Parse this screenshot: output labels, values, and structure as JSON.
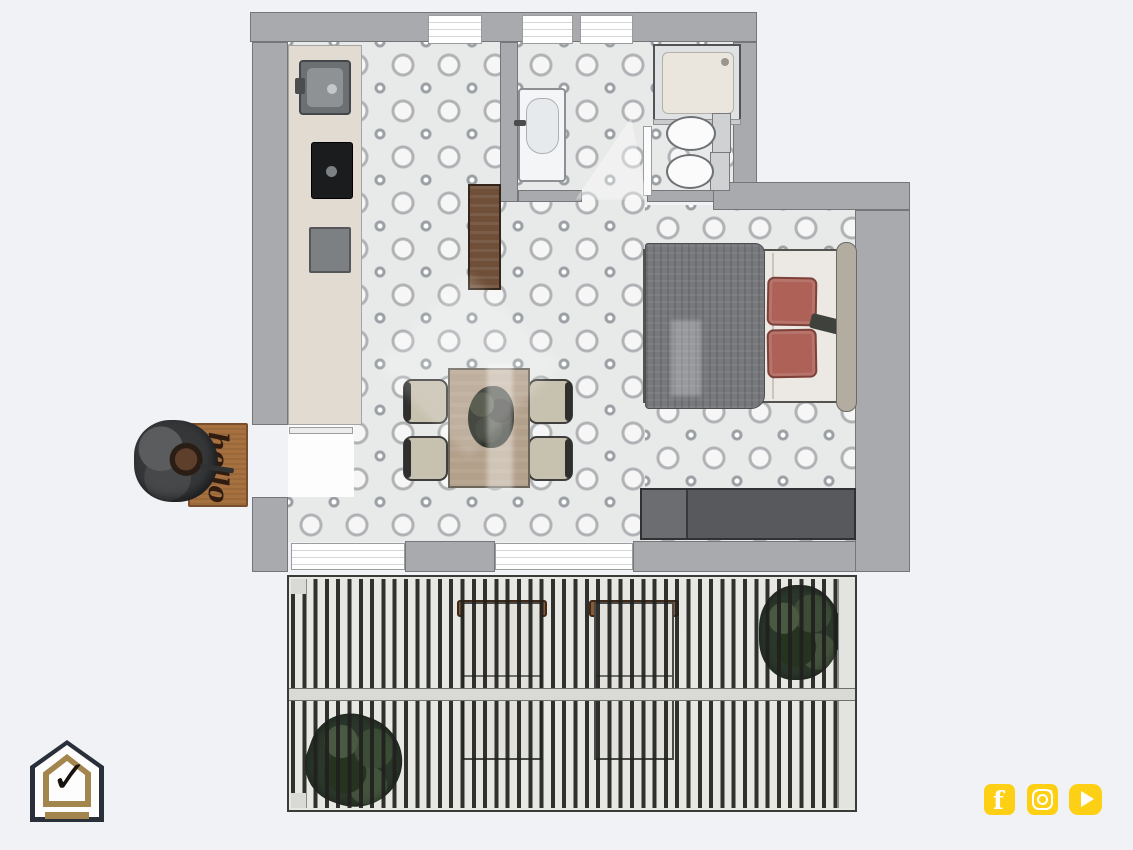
{
  "canvas": {
    "width": 1133,
    "height": 850,
    "background_color": "#f1f2f6"
  },
  "floorplan": {
    "type": "apartment-top-view-render",
    "doormat_text": "hello",
    "rooms": [
      "entrance",
      "kitchen",
      "living-dining",
      "bathroom",
      "bedroom",
      "terrace"
    ],
    "furniture": [
      "kitchen-counter",
      "sink",
      "cooktop",
      "sideboard",
      "dining-table",
      "4-chairs",
      "double-bed",
      "wardrobe",
      "washbasin",
      "shower",
      "bidet",
      "toilet",
      "2-sun-loungers",
      "terrace-plants",
      "entry-plant",
      "doormat"
    ],
    "colors": {
      "wall": "#a8aaad",
      "wall_outline": "#74767a",
      "tile_base": "#e8e9e9",
      "tile_motif": "#b0b2b5",
      "counter": "#e1dbd2",
      "wood_dark": "#6f4f38",
      "wood_table": "#b3a08b",
      "bed_blanket": "#76787c",
      "bed_pillow": "#ad6157",
      "wardrobe": "#57595c",
      "terrace_slat": "#20201e",
      "plant_green": "#2b372a",
      "lounger_wood": "#8a5a35",
      "doormat": "#a6713f"
    }
  },
  "branding": {
    "logo": {
      "name": "house-check-logo",
      "outline_color": "#29303a",
      "gold_color": "#a3854e",
      "check_glyph": "✓"
    },
    "social": {
      "color": "#fdd016",
      "icons": [
        {
          "name": "facebook",
          "glyph": "f"
        },
        {
          "name": "instagram",
          "glyph": ""
        },
        {
          "name": "youtube",
          "glyph": ""
        }
      ]
    }
  }
}
